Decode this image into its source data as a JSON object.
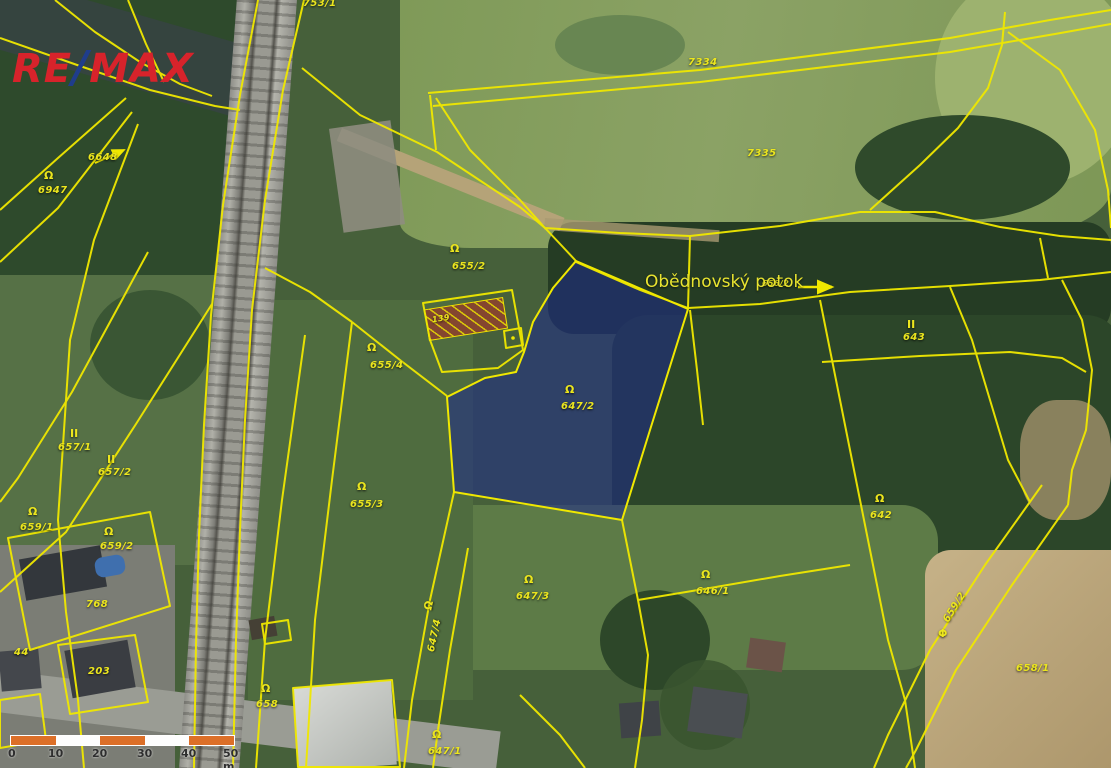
{
  "logo": {
    "re": "RE",
    "slash": "/",
    "max": "MAX"
  },
  "stream_label": {
    "name": "Obědnovský potok",
    "parcel": "656/2"
  },
  "highlighted_parcel": {
    "number": "647/2"
  },
  "scale_bar": {
    "ticks": [
      "0",
      "10",
      "20",
      "30",
      "40",
      "50 m"
    ]
  },
  "symbols": {
    "grassland": "Ω",
    "arable": "II",
    "pipe": "Φ"
  },
  "colors": {
    "boundary_yellow": "#f0e800",
    "label_yellow": "#ece61e",
    "highlight_blue": "rgba(30,40,140,0.55)",
    "scale_orange": "#dc6f28",
    "logo_red": "#d7232b",
    "logo_blue": "#1f3d8c"
  },
  "parcels": [
    {
      "label": "753/1"
    },
    {
      "label": "7334"
    },
    {
      "label": "7335"
    },
    {
      "label": "6648"
    },
    {
      "label": "6947"
    },
    {
      "label": "655/2"
    },
    {
      "label": "655/4"
    },
    {
      "label": "655/3"
    },
    {
      "label": "657/1"
    },
    {
      "label": "657/2"
    },
    {
      "label": "659/1"
    },
    {
      "label": "659/2"
    },
    {
      "label": "768"
    },
    {
      "label": "203"
    },
    {
      "label": "44"
    },
    {
      "label": "658"
    },
    {
      "label": "139"
    },
    {
      "label": "647/4"
    },
    {
      "label": "647/3"
    },
    {
      "label": "647/2"
    },
    {
      "label": "647/1"
    },
    {
      "label": "646/1"
    },
    {
      "label": "642"
    },
    {
      "label": "643"
    },
    {
      "label": "659/2"
    },
    {
      "label": "658/1"
    },
    {
      "label": "656/2"
    }
  ]
}
